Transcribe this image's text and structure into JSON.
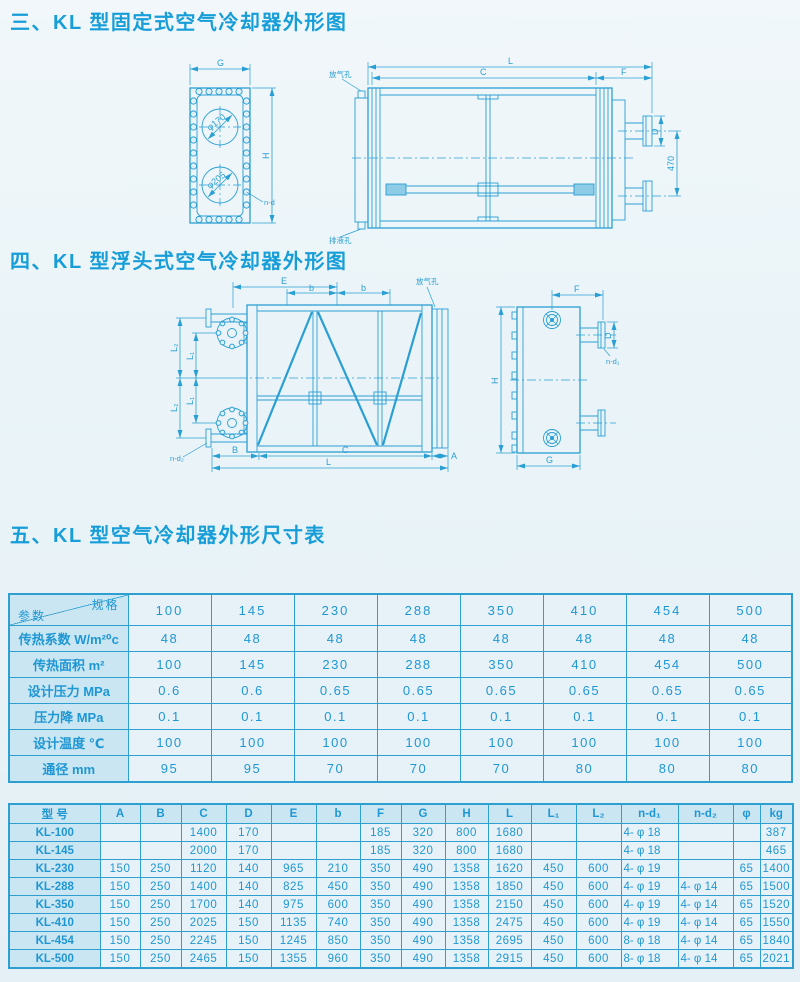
{
  "page": {
    "accent": "#2a9fd4",
    "background": "#eaf4f8"
  },
  "section3": {
    "title": "三、KL 型固定式空气冷却器外形图",
    "front_view": {
      "dim_G": "G",
      "dim_H": "H",
      "label_nd": "n-d",
      "label_phi170": "φ170",
      "label_phi205": "φ205"
    },
    "side_view": {
      "dim_L": "L",
      "dim_C": "C",
      "dim_F": "F",
      "dim_D": "D",
      "dim_470": "470",
      "label_vent": "放气孔",
      "label_drain": "排液孔"
    }
  },
  "section4": {
    "title": "四、KL 型浮头式空气冷却器外形图",
    "main_view": {
      "dim_E": "E",
      "dim_b1": "b",
      "dim_b2": "b",
      "dim_L1_top": "L₁",
      "dim_L1_bottom": "L₁",
      "dim_L2_top": "L₂",
      "dim_L2_bottom": "L₂",
      "dim_B": "B",
      "dim_C": "C",
      "dim_A": "A",
      "dim_L": "L",
      "label_nd2": "n-d₂",
      "label_vent": "放气孔"
    },
    "side_view": {
      "dim_F": "F",
      "dim_D": "D",
      "dim_H": "H",
      "dim_G": "G",
      "label_nd1": "n-d₁"
    }
  },
  "section5": {
    "title": "五、KL 型空气冷却器外形尺寸表"
  },
  "table1": {
    "corner": {
      "top_right": "规格",
      "bottom_left": "参数"
    },
    "columns": [
      "100",
      "145",
      "230",
      "288",
      "350",
      "410",
      "454",
      "500"
    ],
    "rows": [
      {
        "label": "传热系数 W/m²⁰c",
        "values": [
          "48",
          "48",
          "48",
          "48",
          "48",
          "48",
          "48",
          "48"
        ]
      },
      {
        "label": "传热面积 m²",
        "values": [
          "100",
          "145",
          "230",
          "288",
          "350",
          "410",
          "454",
          "500"
        ]
      },
      {
        "label": "设计压力 MPa",
        "values": [
          "0.6",
          "0.6",
          "0.65",
          "0.65",
          "0.65",
          "0.65",
          "0.65",
          "0.65"
        ]
      },
      {
        "label": "压力降 MPa",
        "values": [
          "0.1",
          "0.1",
          "0.1",
          "0.1",
          "0.1",
          "0.1",
          "0.1",
          "0.1"
        ]
      },
      {
        "label": "设计温度 ℃",
        "values": [
          "100",
          "100",
          "100",
          "100",
          "100",
          "100",
          "100",
          "100"
        ]
      },
      {
        "label": "通径 mm",
        "values": [
          "95",
          "95",
          "70",
          "70",
          "70",
          "80",
          "80",
          "80"
        ]
      }
    ]
  },
  "table2": {
    "headers": [
      "型  号",
      "A",
      "B",
      "C",
      "D",
      "E",
      "b",
      "F",
      "G",
      "H",
      "L",
      "L₁",
      "L₂",
      "n-d₁",
      "n-d₂",
      "φ",
      "kg"
    ],
    "rows": [
      {
        "model": "KL-100",
        "values": [
          "",
          "",
          "1400",
          "170",
          "",
          "",
          "185",
          "320",
          "800",
          "1680",
          "",
          "",
          "4- φ 18",
          "",
          "",
          "387"
        ]
      },
      {
        "model": "KL-145",
        "values": [
          "",
          "",
          "2000",
          "170",
          "",
          "",
          "185",
          "320",
          "800",
          "1680",
          "",
          "",
          "4- φ 18",
          "",
          "",
          "465"
        ]
      },
      {
        "model": "KL-230",
        "values": [
          "150",
          "250",
          "1120",
          "140",
          "965",
          "210",
          "350",
          "490",
          "1358",
          "1620",
          "450",
          "600",
          "4- φ 19",
          "",
          "65",
          "1400"
        ]
      },
      {
        "model": "KL-288",
        "values": [
          "150",
          "250",
          "1400",
          "140",
          "825",
          "450",
          "350",
          "490",
          "1358",
          "1850",
          "450",
          "600",
          "4- φ 19",
          "4- φ 14",
          "65",
          "1500"
        ]
      },
      {
        "model": "KL-350",
        "values": [
          "150",
          "250",
          "1700",
          "140",
          "975",
          "600",
          "350",
          "490",
          "1358",
          "2150",
          "450",
          "600",
          "4- φ 19",
          "4- φ 14",
          "65",
          "1520"
        ]
      },
      {
        "model": "KL-410",
        "values": [
          "150",
          "250",
          "2025",
          "150",
          "1135",
          "740",
          "350",
          "490",
          "1358",
          "2475",
          "450",
          "600",
          "4- φ 19",
          "4- φ 14",
          "65",
          "1550"
        ]
      },
      {
        "model": "KL-454",
        "values": [
          "150",
          "250",
          "2245",
          "150",
          "1245",
          "850",
          "350",
          "490",
          "1358",
          "2695",
          "450",
          "600",
          "8- φ 18",
          "4- φ 14",
          "65",
          "1840"
        ]
      },
      {
        "model": "KL-500",
        "values": [
          "150",
          "250",
          "2465",
          "150",
          "1355",
          "960",
          "350",
          "490",
          "1358",
          "2915",
          "450",
          "600",
          "8- φ 18",
          "4- φ 14",
          "65",
          "2021"
        ]
      }
    ]
  }
}
